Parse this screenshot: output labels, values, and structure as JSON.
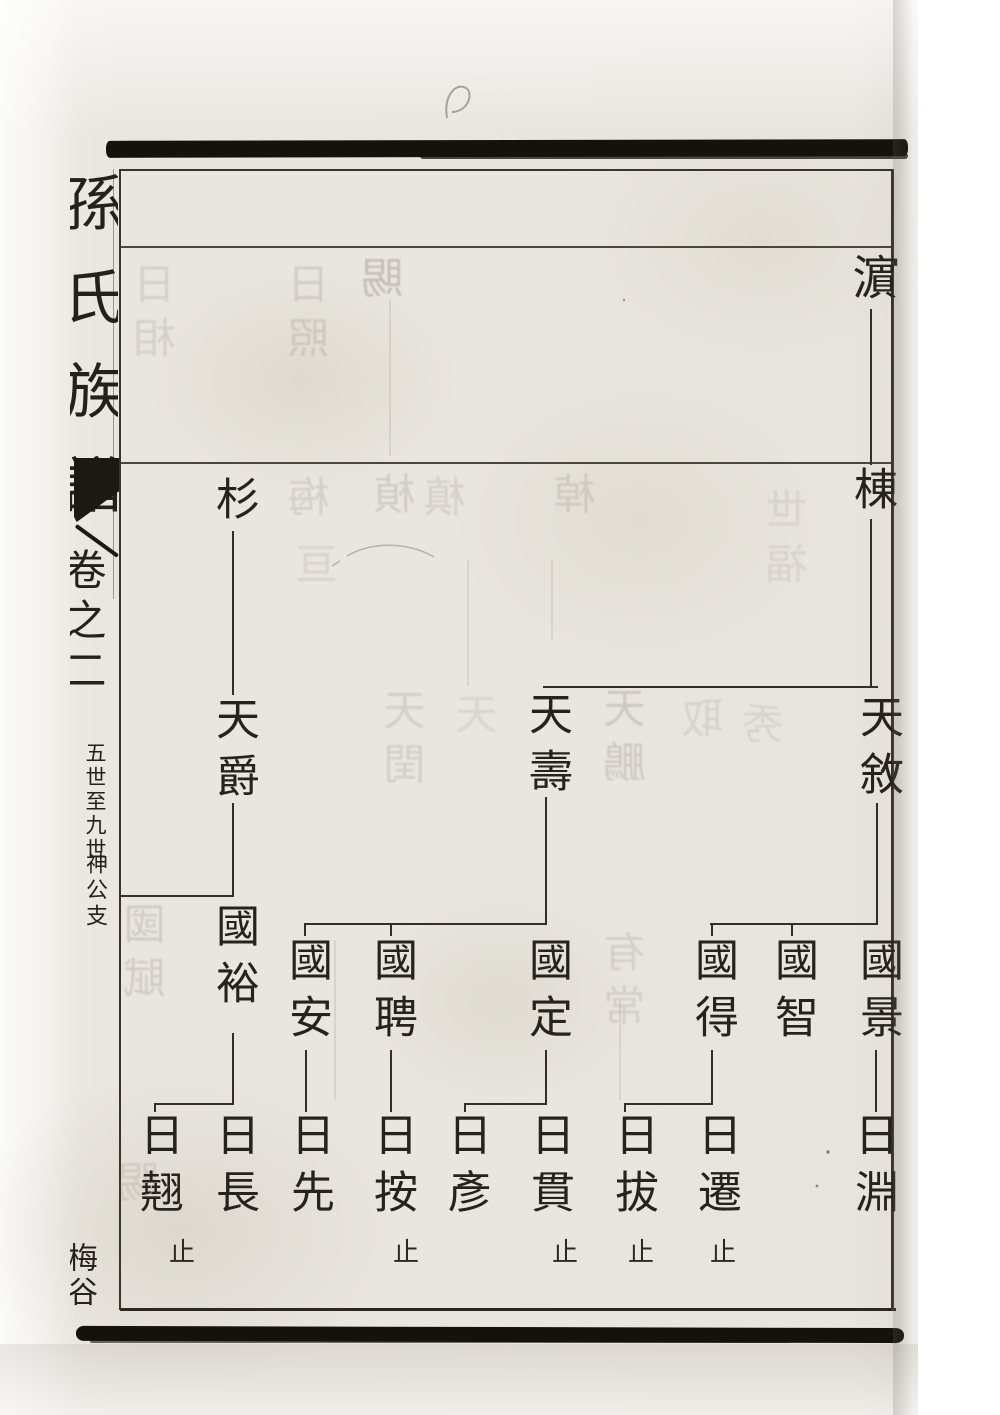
{
  "document_type": "scanned genealogy book page (Chinese family register, woodblock print)",
  "palette": {
    "ink": "#26231d",
    "tree_line": "#332e26",
    "frame_line": "#3a352c",
    "paper": "#e9e6df",
    "black_strip": "#15120c"
  },
  "spine": {
    "title": "孫氏族譜",
    "volume": "卷之二",
    "note_range": "五世至九世",
    "note_branch": "神公支",
    "note_bottom": "梅谷",
    "fishtail": "fishtail-printers-mark"
  },
  "tree": {
    "stop_label": "止",
    "persons": [
      {
        "id": "bin",
        "name": "濵",
        "gen": 5,
        "x": 871,
        "y": 253,
        "size": 47
      },
      {
        "id": "dong",
        "name": "棟",
        "gen": 6,
        "x": 871,
        "y": 466
      },
      {
        "id": "shan",
        "name": "杉",
        "gen": 6,
        "x": 233,
        "y": 476
      },
      {
        "id": "tianjue",
        "name": "天爵",
        "gen": 7,
        "x": 233,
        "y": 696
      },
      {
        "id": "tianshou",
        "name": "天壽",
        "gen": 7,
        "x": 546,
        "y": 691
      },
      {
        "id": "tianxu",
        "name": "天敘",
        "gen": 7,
        "x": 877,
        "y": 694
      },
      {
        "id": "guoyu",
        "name": "國裕",
        "gen": 8,
        "x": 233,
        "y": 903
      },
      {
        "id": "guoan",
        "name": "國安",
        "gen": 8,
        "x": 306,
        "y": 937
      },
      {
        "id": "guopin",
        "name": "國聘",
        "gen": 8,
        "x": 391,
        "y": 937
      },
      {
        "id": "guoding",
        "name": "國定",
        "gen": 8,
        "x": 546,
        "y": 937
      },
      {
        "id": "guode",
        "name": "國得",
        "gen": 8,
        "x": 712,
        "y": 937
      },
      {
        "id": "guozhi",
        "name": "國智",
        "gen": 8,
        "x": 792,
        "y": 937
      },
      {
        "id": "guojing",
        "name": "國景",
        "gen": 8,
        "x": 877,
        "y": 937
      },
      {
        "id": "riqiao",
        "name": "日翹",
        "gen": 9,
        "x": 157,
        "y": 1112,
        "stop": true,
        "stop_dx": 25
      },
      {
        "id": "richang",
        "name": "日長",
        "gen": 9,
        "x": 233,
        "y": 1112
      },
      {
        "id": "rixian",
        "name": "日先",
        "gen": 9,
        "x": 308,
        "y": 1112
      },
      {
        "id": "rian",
        "name": "日按",
        "gen": 9,
        "x": 391,
        "y": 1112,
        "stop": true,
        "stop_dx": 15
      },
      {
        "id": "riyan",
        "name": "日彥",
        "gen": 9,
        "x": 465,
        "y": 1112
      },
      {
        "id": "riguan",
        "name": "日貫",
        "gen": 9,
        "x": 548,
        "y": 1112,
        "stop": true,
        "stop_dx": 17
      },
      {
        "id": "riba",
        "name": "日拔",
        "gen": 9,
        "x": 632,
        "y": 1112,
        "stop": true,
        "stop_dx": 9
      },
      {
        "id": "riqian",
        "name": "日遷",
        "gen": 9,
        "x": 715,
        "y": 1112,
        "stop": true,
        "stop_dx": 8
      },
      {
        "id": "riyuan",
        "name": "日淵",
        "gen": 9,
        "x": 872,
        "y": 1112
      }
    ],
    "families": [
      {
        "parent": "濵",
        "children": [
          "棟"
        ]
      },
      {
        "parent": "棟",
        "children": [
          "天敘",
          "天壽"
        ]
      },
      {
        "parent": "杉",
        "children": [
          "天爵"
        ]
      },
      {
        "parent": "天爵",
        "children": [
          "國裕"
        ],
        "line_continues_to_left_page_edge": true
      },
      {
        "parent": "天壽",
        "children": [
          "國定",
          "國聘",
          "國安"
        ]
      },
      {
        "parent": "天敘",
        "children": [
          "國景",
          "國智",
          "國得"
        ]
      },
      {
        "parent": "國裕",
        "children": [
          "日長",
          "日翹"
        ]
      },
      {
        "parent": "國安",
        "children": [
          "日先"
        ]
      },
      {
        "parent": "國聘",
        "children": [
          "日按"
        ]
      },
      {
        "parent": "國定",
        "children": [
          "日貫",
          "日彥"
        ]
      },
      {
        "parent": "國得",
        "children": [
          "日遷",
          "日拔"
        ]
      },
      {
        "parent": "國景",
        "children": [
          "日淵"
        ]
      }
    ],
    "lines": [
      {
        "type": "v",
        "x": 871,
        "y1": 309,
        "y2": 465
      },
      {
        "type": "v",
        "x": 871,
        "y1": 519,
        "y2": 687
      },
      {
        "type": "h",
        "y": 687,
        "x1": 543,
        "x2": 878
      },
      {
        "type": "v",
        "x": 233,
        "y1": 531,
        "y2": 695
      },
      {
        "type": "v",
        "x": 233,
        "y1": 803,
        "y2": 896
      },
      {
        "type": "h",
        "y": 896,
        "x1": 119,
        "x2": 234
      },
      {
        "type": "v",
        "x": 546,
        "y1": 797,
        "y2": 924
      },
      {
        "type": "h",
        "y": 924,
        "x1": 304,
        "x2": 547
      },
      {
        "type": "v",
        "x": 877,
        "y1": 803,
        "y2": 924
      },
      {
        "type": "h",
        "y": 924,
        "x1": 710,
        "x2": 878
      },
      {
        "type": "v",
        "x": 305,
        "y1": 924,
        "y2": 936
      },
      {
        "type": "v",
        "x": 391,
        "y1": 924,
        "y2": 936
      },
      {
        "type": "v",
        "x": 712,
        "y1": 924,
        "y2": 936
      },
      {
        "type": "v",
        "x": 792,
        "y1": 924,
        "y2": 936
      },
      {
        "type": "v",
        "x": 233,
        "y1": 1033,
        "y2": 1104
      },
      {
        "type": "h",
        "y": 1104,
        "x1": 154,
        "x2": 234
      },
      {
        "type": "v",
        "x": 155,
        "y1": 1104,
        "y2": 1112
      },
      {
        "type": "v",
        "x": 306,
        "y1": 1050,
        "y2": 1112
      },
      {
        "type": "v",
        "x": 391,
        "y1": 1050,
        "y2": 1112
      },
      {
        "type": "v",
        "x": 546,
        "y1": 1050,
        "y2": 1104
      },
      {
        "type": "h",
        "y": 1104,
        "x1": 464,
        "x2": 547
      },
      {
        "type": "v",
        "x": 465,
        "y1": 1104,
        "y2": 1112
      },
      {
        "type": "v",
        "x": 712,
        "y1": 1050,
        "y2": 1104
      },
      {
        "type": "h",
        "y": 1104,
        "x1": 624,
        "x2": 713
      },
      {
        "type": "v",
        "x": 625,
        "y1": 1104,
        "y2": 1112
      },
      {
        "type": "v",
        "x": 876,
        "y1": 1050,
        "y2": 1112
      }
    ]
  },
  "bleedthrough_ghosts": [
    {
      "x": 158,
      "y": 262,
      "text": "日相",
      "opacity": 0.16
    },
    {
      "x": 312,
      "y": 262,
      "text": "日照",
      "opacity": 0.18
    },
    {
      "x": 386,
      "y": 256,
      "text": "賜",
      "opacity": 0.3
    },
    {
      "x": 312,
      "y": 475,
      "text": "梅",
      "opacity": 0.17
    },
    {
      "x": 398,
      "y": 472,
      "text": "楨",
      "opacity": 0.2
    },
    {
      "x": 448,
      "y": 475,
      "text": "槙",
      "opacity": 0.16
    },
    {
      "x": 578,
      "y": 472,
      "text": "棹",
      "opacity": 0.18
    },
    {
      "x": 320,
      "y": 542,
      "text": "亘",
      "opacity": 0.14
    },
    {
      "x": 790,
      "y": 488,
      "text": "世福",
      "opacity": 0.13
    },
    {
      "x": 408,
      "y": 688,
      "text": "天閏",
      "opacity": 0.17
    },
    {
      "x": 628,
      "y": 686,
      "text": "天鵬",
      "opacity": 0.22
    },
    {
      "x": 480,
      "y": 692,
      "text": "天",
      "opacity": 0.12
    },
    {
      "x": 706,
      "y": 696,
      "text": "取",
      "opacity": 0.14
    },
    {
      "x": 766,
      "y": 702,
      "text": "秀",
      "opacity": 0.13
    },
    {
      "x": 148,
      "y": 902,
      "text": "國賦",
      "opacity": 0.2
    },
    {
      "x": 628,
      "y": 930,
      "text": "有常",
      "opacity": 0.16
    },
    {
      "x": 142,
      "y": 1160,
      "text": "賜",
      "opacity": 0.16
    }
  ],
  "bleedthrough_lines": [
    {
      "x": 390,
      "y1": 300,
      "y2": 456
    },
    {
      "x": 468,
      "y1": 560,
      "y2": 686
    },
    {
      "x": 552,
      "y1": 560,
      "y2": 640
    },
    {
      "x": 335,
      "y1": 940,
      "y2": 1100
    },
    {
      "x": 620,
      "y1": 1000,
      "y2": 1100
    }
  ]
}
